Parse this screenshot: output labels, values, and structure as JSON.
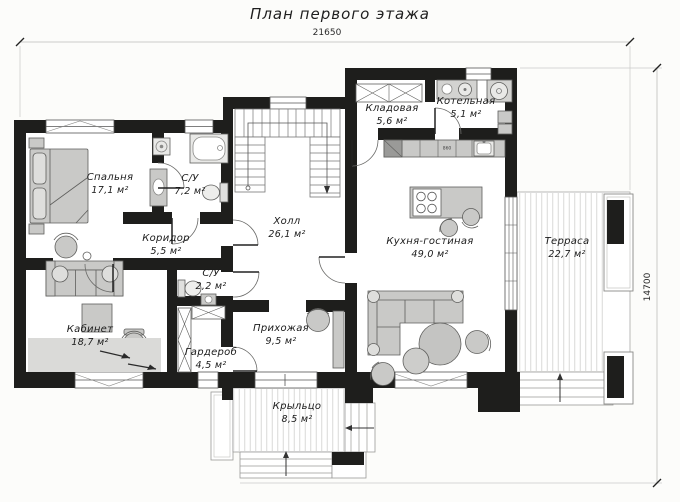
{
  "title": "План первого этажа",
  "dimensions": {
    "width": "21650",
    "height": "14700"
  },
  "rooms": [
    {
      "id": "bedroom",
      "name": "Спальня",
      "area": "17,1 м²"
    },
    {
      "id": "bathroom-1",
      "name": "С/У",
      "area": "7,2 м²"
    },
    {
      "id": "corridor",
      "name": "Коридор",
      "area": "5,5 м²"
    },
    {
      "id": "office",
      "name": "Кабинет",
      "area": "18,7 м²"
    },
    {
      "id": "bathroom-2",
      "name": "С/У",
      "area": "2,2 м²"
    },
    {
      "id": "wardrobe",
      "name": "Гардероб",
      "area": "4,5 м²"
    },
    {
      "id": "hall",
      "name": "Холл",
      "area": "26,1 м²"
    },
    {
      "id": "storage",
      "name": "Кладовая",
      "area": "5,6 м²"
    },
    {
      "id": "boiler-room",
      "name": "Котельная",
      "area": "5,1 м²"
    },
    {
      "id": "kitchen-living",
      "name": "Кухня-гостиная",
      "area": "49,0 м²"
    },
    {
      "id": "entryway",
      "name": "Прихожая",
      "area": "9,5 м²"
    },
    {
      "id": "porch",
      "name": "Крыльцо",
      "area": "8,5 м²"
    },
    {
      "id": "terrace",
      "name": "Терраса",
      "area": "22,7 м²"
    }
  ],
  "annotations": {
    "counter_size": "860"
  },
  "colors": {
    "wall": "#1e1e1c",
    "furniture": "#c9c9c7",
    "deck_stripe": "#d9d9d7"
  }
}
